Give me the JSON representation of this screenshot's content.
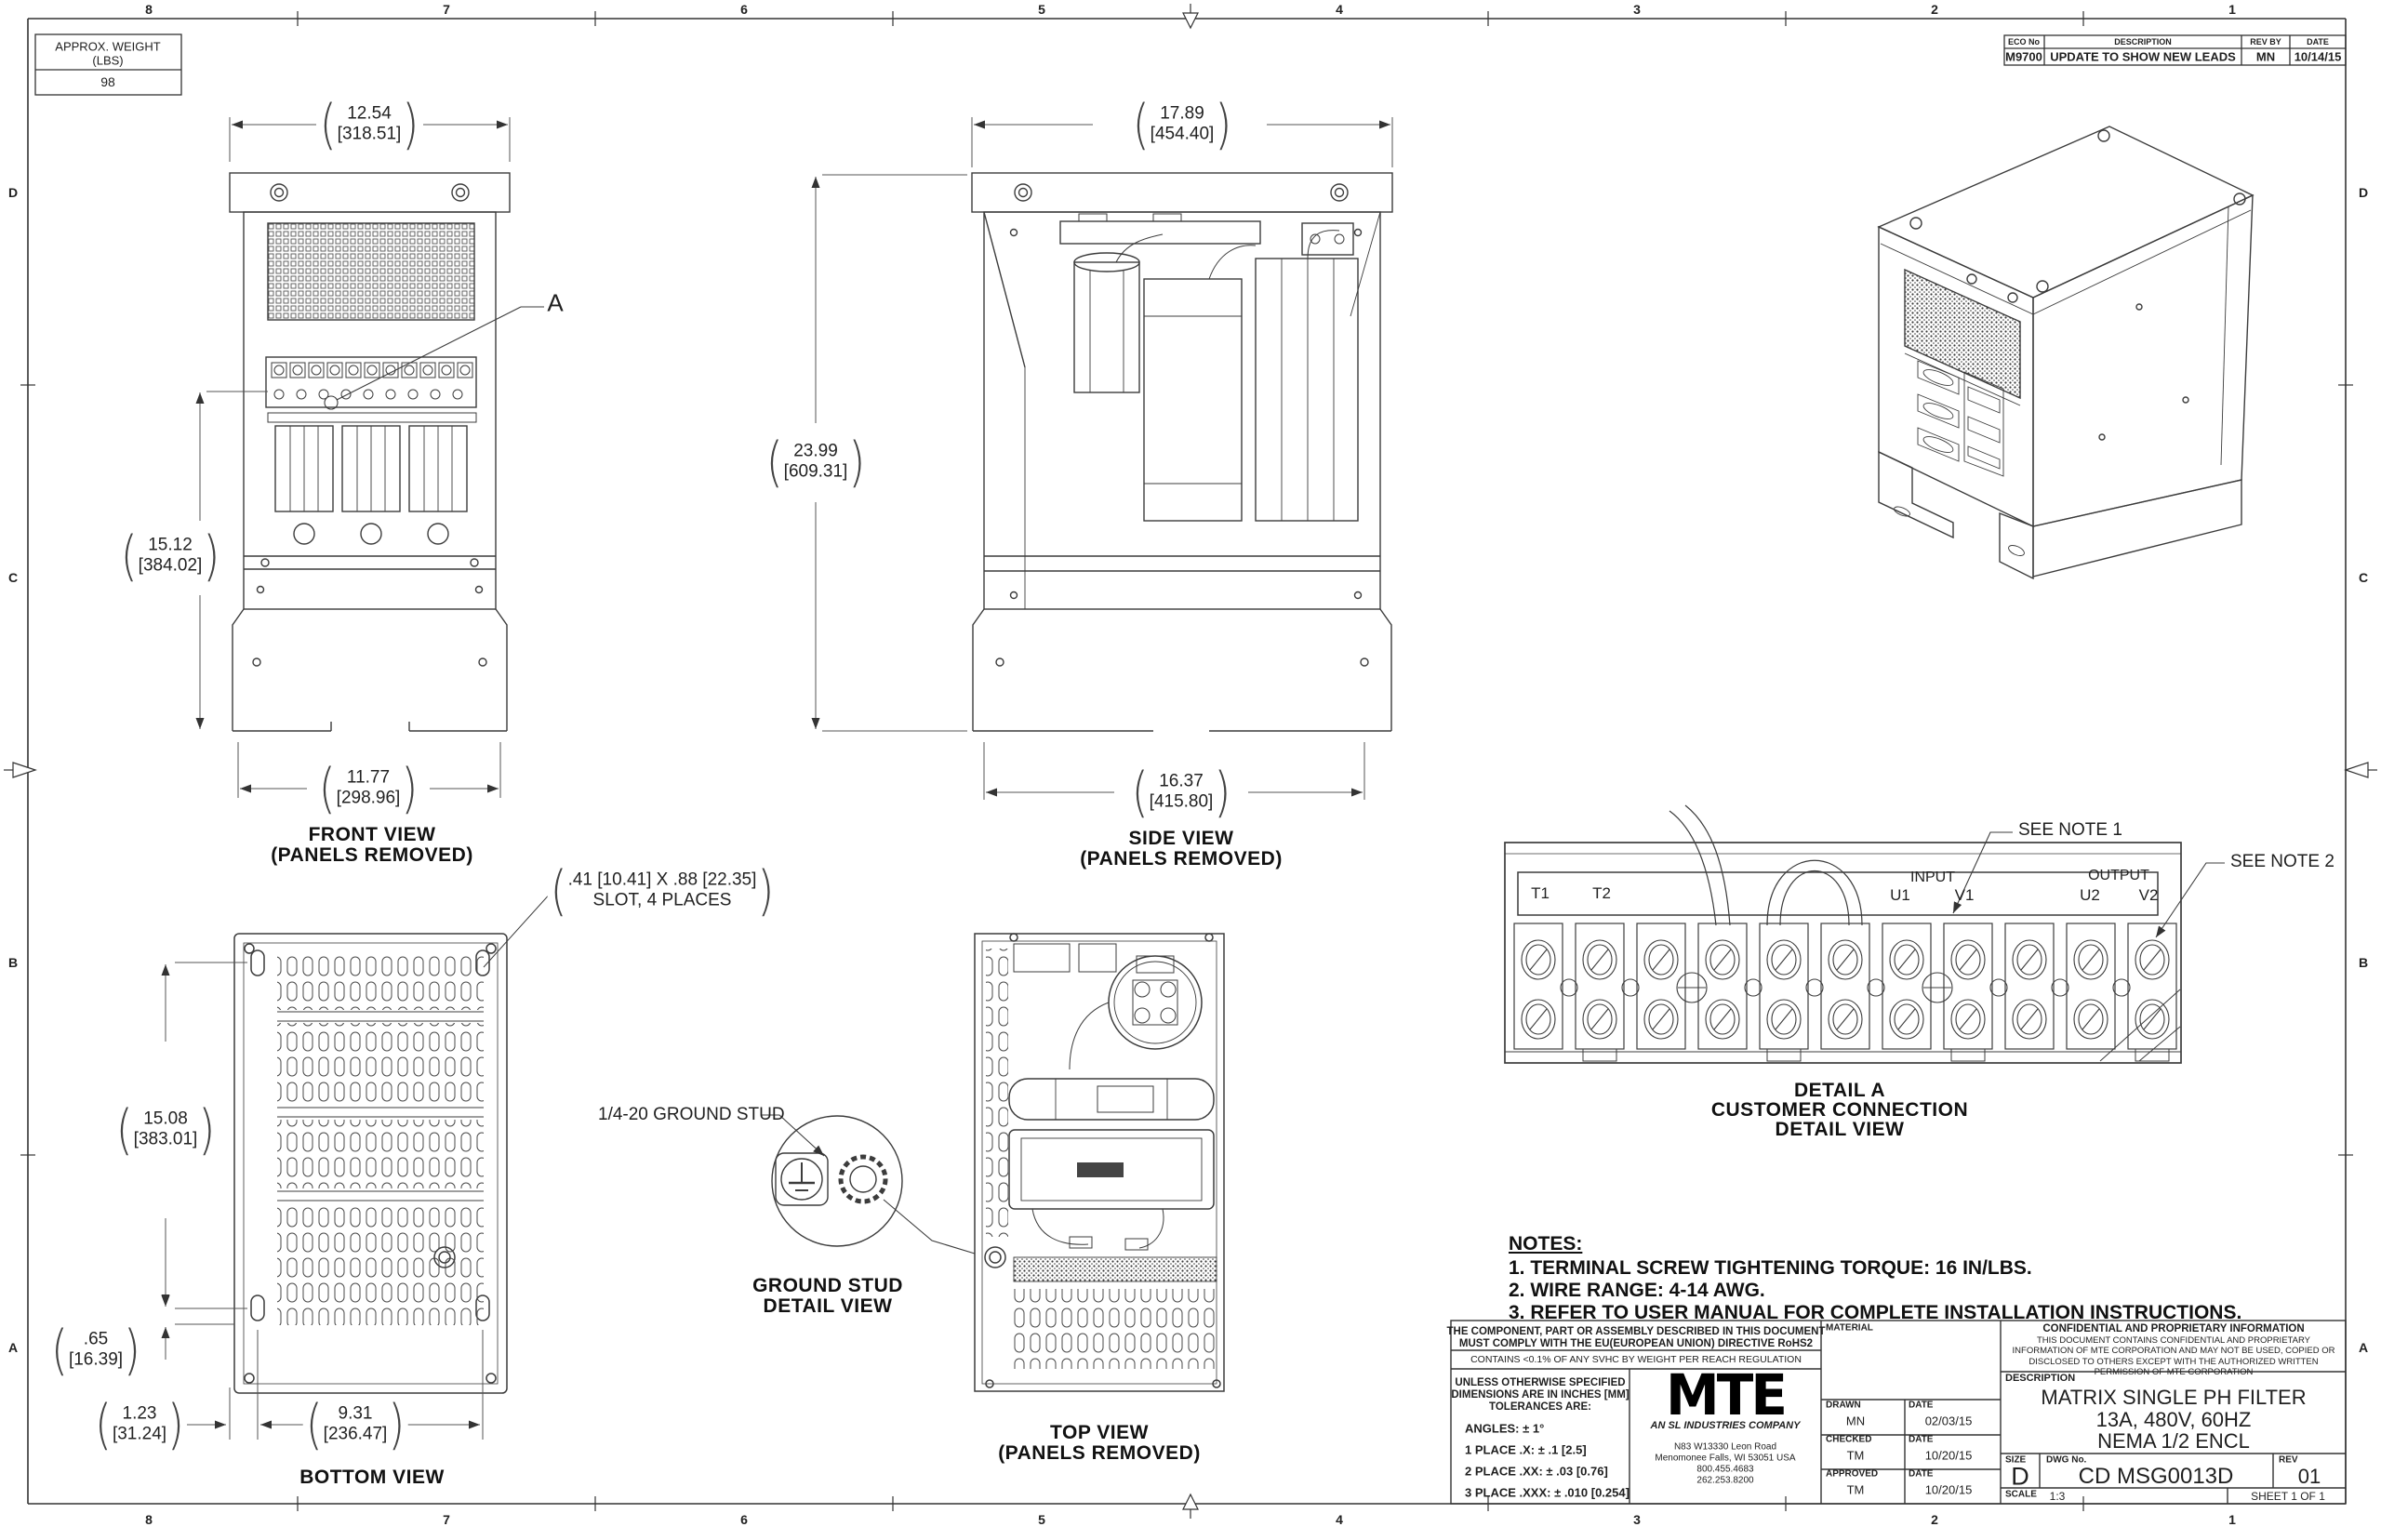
{
  "sheet": {
    "zone_cols": [
      "8",
      "7",
      "6",
      "5",
      "4",
      "3",
      "2",
      "1"
    ],
    "zone_rows": [
      "D",
      "C",
      "B",
      "A"
    ]
  },
  "weight_box": {
    "title_line1": "APPROX. WEIGHT",
    "title_line2": "(LBS)",
    "value": "98"
  },
  "eco_table": {
    "headers": [
      "ECO No",
      "DESCRIPTION",
      "REV BY",
      "DATE"
    ],
    "row": [
      "M9700",
      "UPDATE TO SHOW NEW LEADS",
      "MN",
      "10/14/15"
    ]
  },
  "views": {
    "front": {
      "label_line1": "FRONT VIEW",
      "label_line2": "(PANELS REMOVED)",
      "dim_width_in": "12.54",
      "dim_width_mm": "[318.51]",
      "dim_height_in": "15.12",
      "dim_height_mm": "[384.02]",
      "dim_base_in": "11.77",
      "dim_base_mm": "[298.96]",
      "detail_callout": "A"
    },
    "side": {
      "label_line1": "SIDE VIEW",
      "label_line2": "(PANELS REMOVED)",
      "dim_width_in": "17.89",
      "dim_width_mm": "[454.40]",
      "dim_height_in": "23.99",
      "dim_height_mm": "[609.31]",
      "dim_base_in": "16.37",
      "dim_base_mm": "[415.80]"
    },
    "bottom": {
      "label": "BOTTOM VIEW",
      "dim_height_in": "15.08",
      "dim_height_mm": "[383.01]",
      "dim_offset_in": ".65",
      "dim_offset_mm": "[16.39]",
      "dim_left_in": "1.23",
      "dim_left_mm": "[31.24]",
      "dim_span_in": "9.31",
      "dim_span_mm": "[236.47]",
      "slot_note_line1": ".41 [10.41] X .88 [22.35]",
      "slot_note_line2": "SLOT, 4 PLACES"
    },
    "top": {
      "label_line1": "TOP VIEW",
      "label_line2": "(PANELS REMOVED)"
    },
    "ground_stud": {
      "callout": "1/4-20 GROUND STUD",
      "label_line1": "GROUND STUD",
      "label_line2": "DETAIL VIEW"
    }
  },
  "detail_a": {
    "label_line1": "DETAIL A",
    "label_line2": "CUSTOMER CONNECTION",
    "label_line3": "DETAIL VIEW",
    "see_note_1": "SEE NOTE 1",
    "see_note_2": "SEE NOTE 2",
    "group_input": "INPUT",
    "group_output": "OUTPUT",
    "terminals": [
      "T1",
      "T2",
      "U1",
      "V1",
      "U2",
      "V2"
    ]
  },
  "notes": {
    "title": "NOTES:",
    "items": [
      "1.  TERMINAL SCREW TIGHTENING TORQUE: 16 IN/LBS.",
      "2.  WIRE RANGE: 4-14 AWG.",
      "3.  REFER TO USER MANUAL FOR COMPLETE INSTALLATION INSTRUCTIONS."
    ]
  },
  "title_block": {
    "rohs_line1": "THE COMPONENT, PART OR ASSEMBLY DESCRIBED IN THIS DOCUMENT",
    "rohs_line2": "MUST COMPLY WITH THE EU(EUROPEAN UNION) DIRECTIVE RoHS2",
    "reach": "CONTAINS <0.1% OF ANY SVHC BY WEIGHT PER REACH REGULATION",
    "tol_header_1": "UNLESS OTHERWISE SPECIFIED",
    "tol_header_2": "DIMENSIONS ARE IN INCHES [MM]",
    "tol_header_3": "TOLERANCES ARE:",
    "tol_angles": "ANGLES: ± 1°",
    "tol_1place": "1 PLACE .X: ± .1 [2.5]",
    "tol_2place": "2 PLACE .XX: ± .03 [0.76]",
    "tol_3place": "3 PLACE .XXX: ± .010 [0.254]",
    "logo_text": "MTE",
    "logo_tagline": "AN SL INDUSTRIES COMPANY",
    "address_line1": "N83 W13330 Leon Road",
    "address_line2": "Menomonee Falls, WI 53051 USA",
    "address_line3": "800.455.4683",
    "address_line4": "262.253.8200",
    "material_label": "MATERIAL",
    "drawn_label": "DRAWN",
    "drawn_by": "MN",
    "drawn_date_label": "DATE",
    "drawn_date": "02/03/15",
    "checked_label": "CHECKED",
    "checked_by": "TM",
    "checked_date_label": "DATE",
    "checked_date": "10/20/15",
    "approved_label": "APPROVED",
    "approved_by": "TM",
    "approved_date_label": "DATE",
    "approved_date": "10/20/15",
    "confidential_title": "CONFIDENTIAL AND PROPRIETARY INFORMATION",
    "confidential_body": "THIS DOCUMENT CONTAINS CONFIDENTIAL AND PROPRIETARY INFORMATION OF MTE CORPORATION AND MAY NOT BE USED, COPIED OR DISCLOSED TO OTHERS EXCEPT WITH THE AUTHORIZED WRITTEN PERMISSION OF MTE CORPORATION",
    "description_label": "DESCRIPTION",
    "description_line1": "MATRIX SINGLE PH FILTER",
    "description_line2": "13A, 480V, 60HZ",
    "description_line3": "NEMA 1/2 ENCL",
    "size_label": "SIZE",
    "size": "D",
    "dwg_label": "DWG No.",
    "dwg_no": "CD MSG0013D",
    "rev_label": "REV",
    "rev": "01",
    "scale_label": "SCALE",
    "scale": "1:3",
    "sheet_label": "SHEET 1  OF 1"
  }
}
